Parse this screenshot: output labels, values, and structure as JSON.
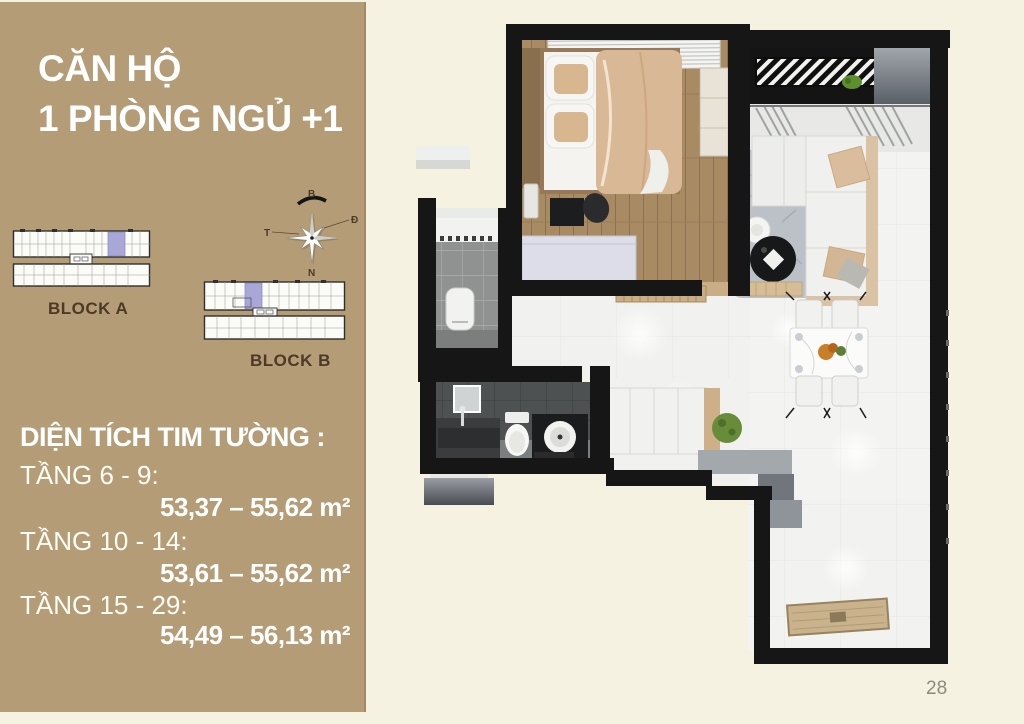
{
  "page": {
    "number": "28"
  },
  "sidebar": {
    "title_line1": "CĂN HỘ",
    "title_line2": "1 PHÒNG NGỦ +1",
    "block_a_label": "BLOCK A",
    "block_b_label": "BLOCK B",
    "compass": {
      "north": "B",
      "east": "Đ",
      "west": "T",
      "south": "N"
    },
    "area_section": {
      "heading": "DIỆN TÍCH TIM TƯỜNG :",
      "rows": [
        {
          "label": "TẦNG 6 - 9:",
          "value": "53,37 – 55,62 m²"
        },
        {
          "label": "TẦNG 10 - 14:",
          "value": "53,61 – 55,62 m²"
        },
        {
          "label": "TẦNG 15 - 29:",
          "value": "54,49 – 56,13 m²"
        }
      ]
    },
    "colors": {
      "panel": "#b49c77",
      "text": "#ffffff",
      "block_label": "#4c3a27",
      "highlight_unit": "#a9a7d8"
    }
  },
  "floorplan": {
    "colors": {
      "wall": "#161616",
      "wood_floor": "#a88a63",
      "white_floor": "#f3f3f1",
      "bath_tile": "#4e5152",
      "shower_tile": "#8f9291",
      "duvet": "#d9b896",
      "rug": "#bcc1c8",
      "plant": "#678c3a",
      "doormat": "#c9b28c",
      "background": "#f5f2e2"
    }
  }
}
